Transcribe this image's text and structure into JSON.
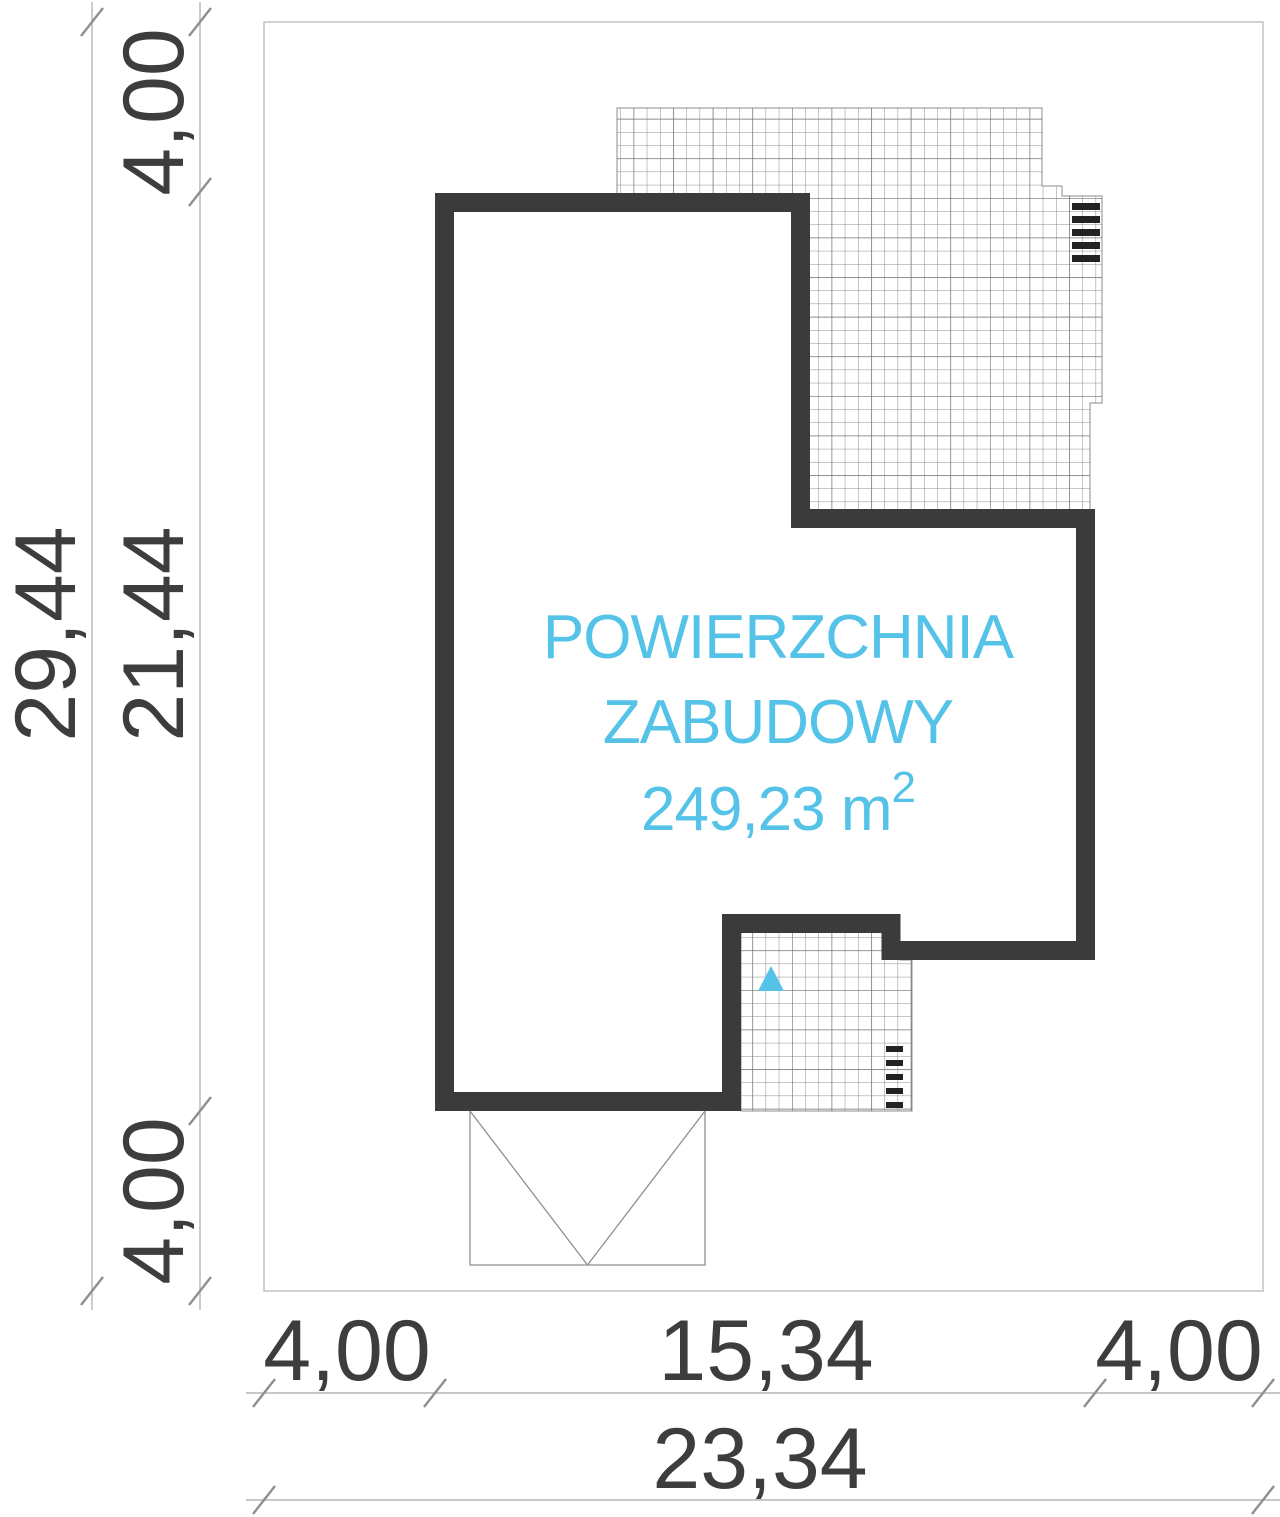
{
  "title": {
    "area_line1": "POWIERZCHNIA",
    "area_line2": "ZABUDOWY",
    "area_value": "249,23 m",
    "area_value_exponent": "2"
  },
  "dimensions": {
    "left_total": "29,44",
    "left_segment_top": "4,00",
    "left_segment_middle": "21,44",
    "left_segment_bottom": "4,00",
    "bottom_segment_left": "4,00",
    "bottom_segment_middle": "15,34",
    "bottom_segment_right": "4,00",
    "bottom_total": "23,34"
  },
  "colors": {
    "accent_cyan": "#55c3e8",
    "wall_dark": "#3b3b3b",
    "dimension_text": "#3d3d3d",
    "dimension_line": "#b5b5b5",
    "tick_mark": "#8f8f8f",
    "plot_border": "#c6c6c6",
    "hatch_line": "#8c8c8c",
    "stair_mark": "#222222"
  }
}
